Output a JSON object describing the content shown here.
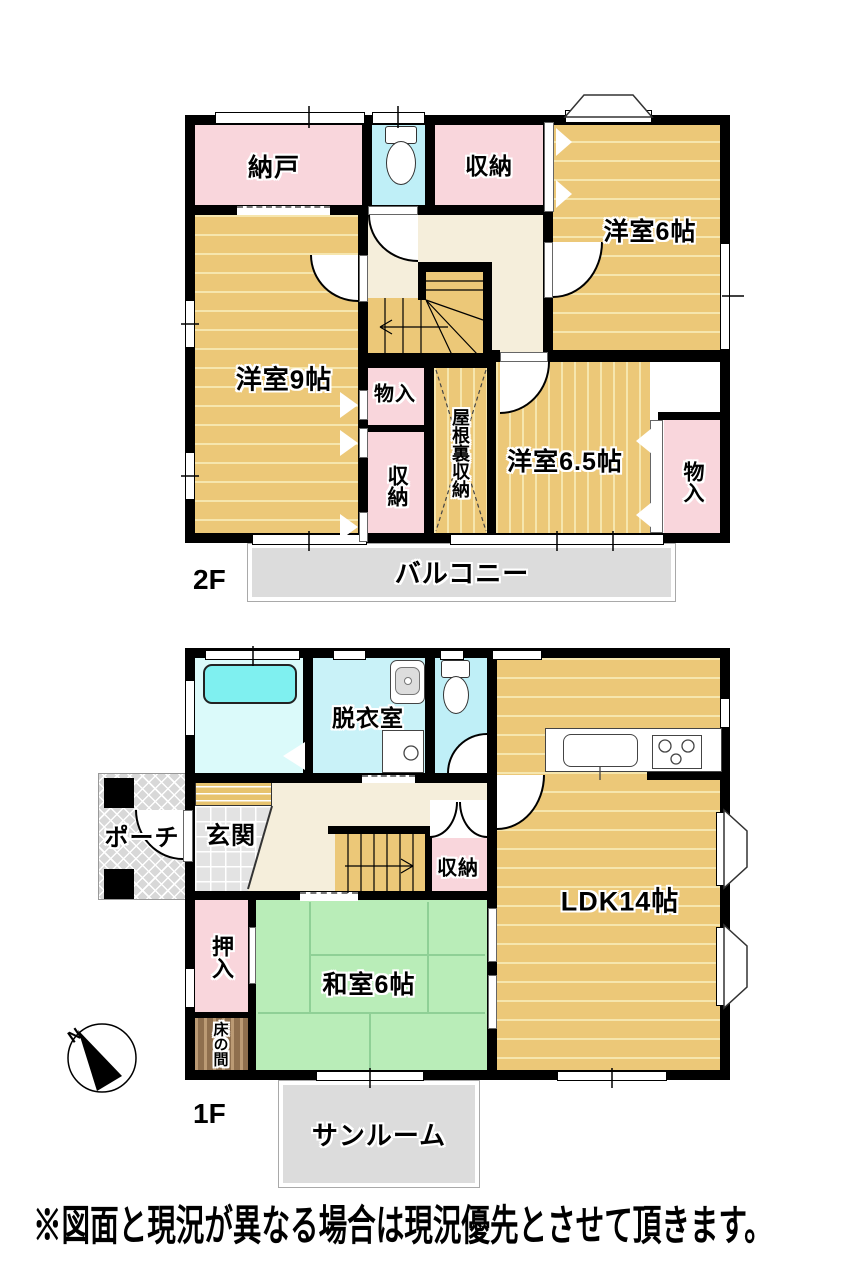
{
  "disclaimer": "※図面と現況が異なる場合は現況優先とさせて頂きます。",
  "compass": {
    "north": "N"
  },
  "colors": {
    "wall": "#000000",
    "western_room": "#ecc878",
    "closet_pink": "#f9d6dc",
    "hall_beige": "#f5eedb",
    "wet_area_cyan": "#c9f2f8",
    "tatami_green": "#b9edb8",
    "balcony_gray": "#dcdcdc",
    "tokonoma_brown": "#8f6f4e"
  },
  "floor2": {
    "name": "2F",
    "nando": "納戸",
    "closet_top": "収納",
    "yoshitsu6": "洋室6帖",
    "yoshitsu9": "洋室9帖",
    "monoire_mid": "物入",
    "closet_mid": "収納",
    "attic": "屋根裏収納",
    "yoshitsu65": "洋室6.5帖",
    "monoire_right": "物入",
    "balcony": "バルコニー"
  },
  "floor1": {
    "name": "1F",
    "datsui": "脱衣室",
    "ldk": "LDK14帖",
    "porch": "ポーチ",
    "genkan": "玄関",
    "closet": "収納",
    "oshiire": "押入",
    "washitsu": "和室6帖",
    "tokonoma": "床の間",
    "sunroom": "サンルーム"
  }
}
